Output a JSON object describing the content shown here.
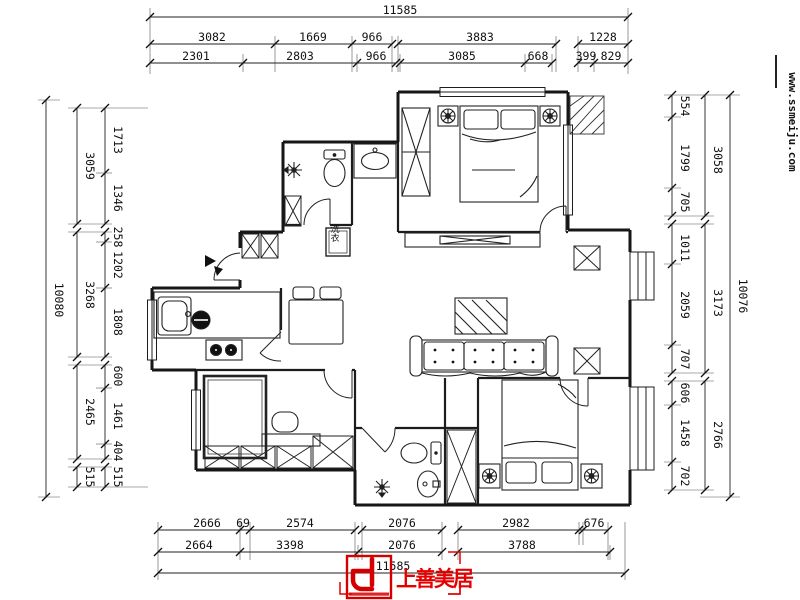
{
  "watermark": {
    "url_text": "www.ssmeiju.com",
    "color": "#b30000"
  },
  "brand": {
    "name": "上善美居",
    "color": "#e60000"
  },
  "plan": {
    "laundry_label": "洗衣"
  },
  "dimensions": {
    "top": {
      "total": "11585",
      "row2": [
        "3082",
        "1669",
        "966",
        "3883",
        "1228"
      ],
      "row3": [
        "2301",
        "2803",
        "966",
        "3085",
        "668",
        "399",
        "829"
      ]
    },
    "bottom": {
      "row1": [
        "2666",
        "69",
        "2574",
        "2076",
        "2982",
        "676"
      ],
      "row2": [
        "2664",
        "3398",
        "2076",
        "3788"
      ],
      "total": "11585"
    },
    "left": {
      "total": "10080",
      "outer": [
        "3059",
        "3268",
        "2465",
        "515"
      ],
      "inner": [
        "1713",
        "1346",
        "258",
        "1202",
        "1808",
        "600",
        "1461",
        "404",
        "515"
      ]
    },
    "right": {
      "total": "10076",
      "outer": [
        "3058",
        "3173",
        "2766"
      ],
      "inner": [
        "554",
        "1799",
        "705",
        "1011",
        "2059",
        "707",
        "606",
        "1458",
        "702"
      ]
    }
  }
}
